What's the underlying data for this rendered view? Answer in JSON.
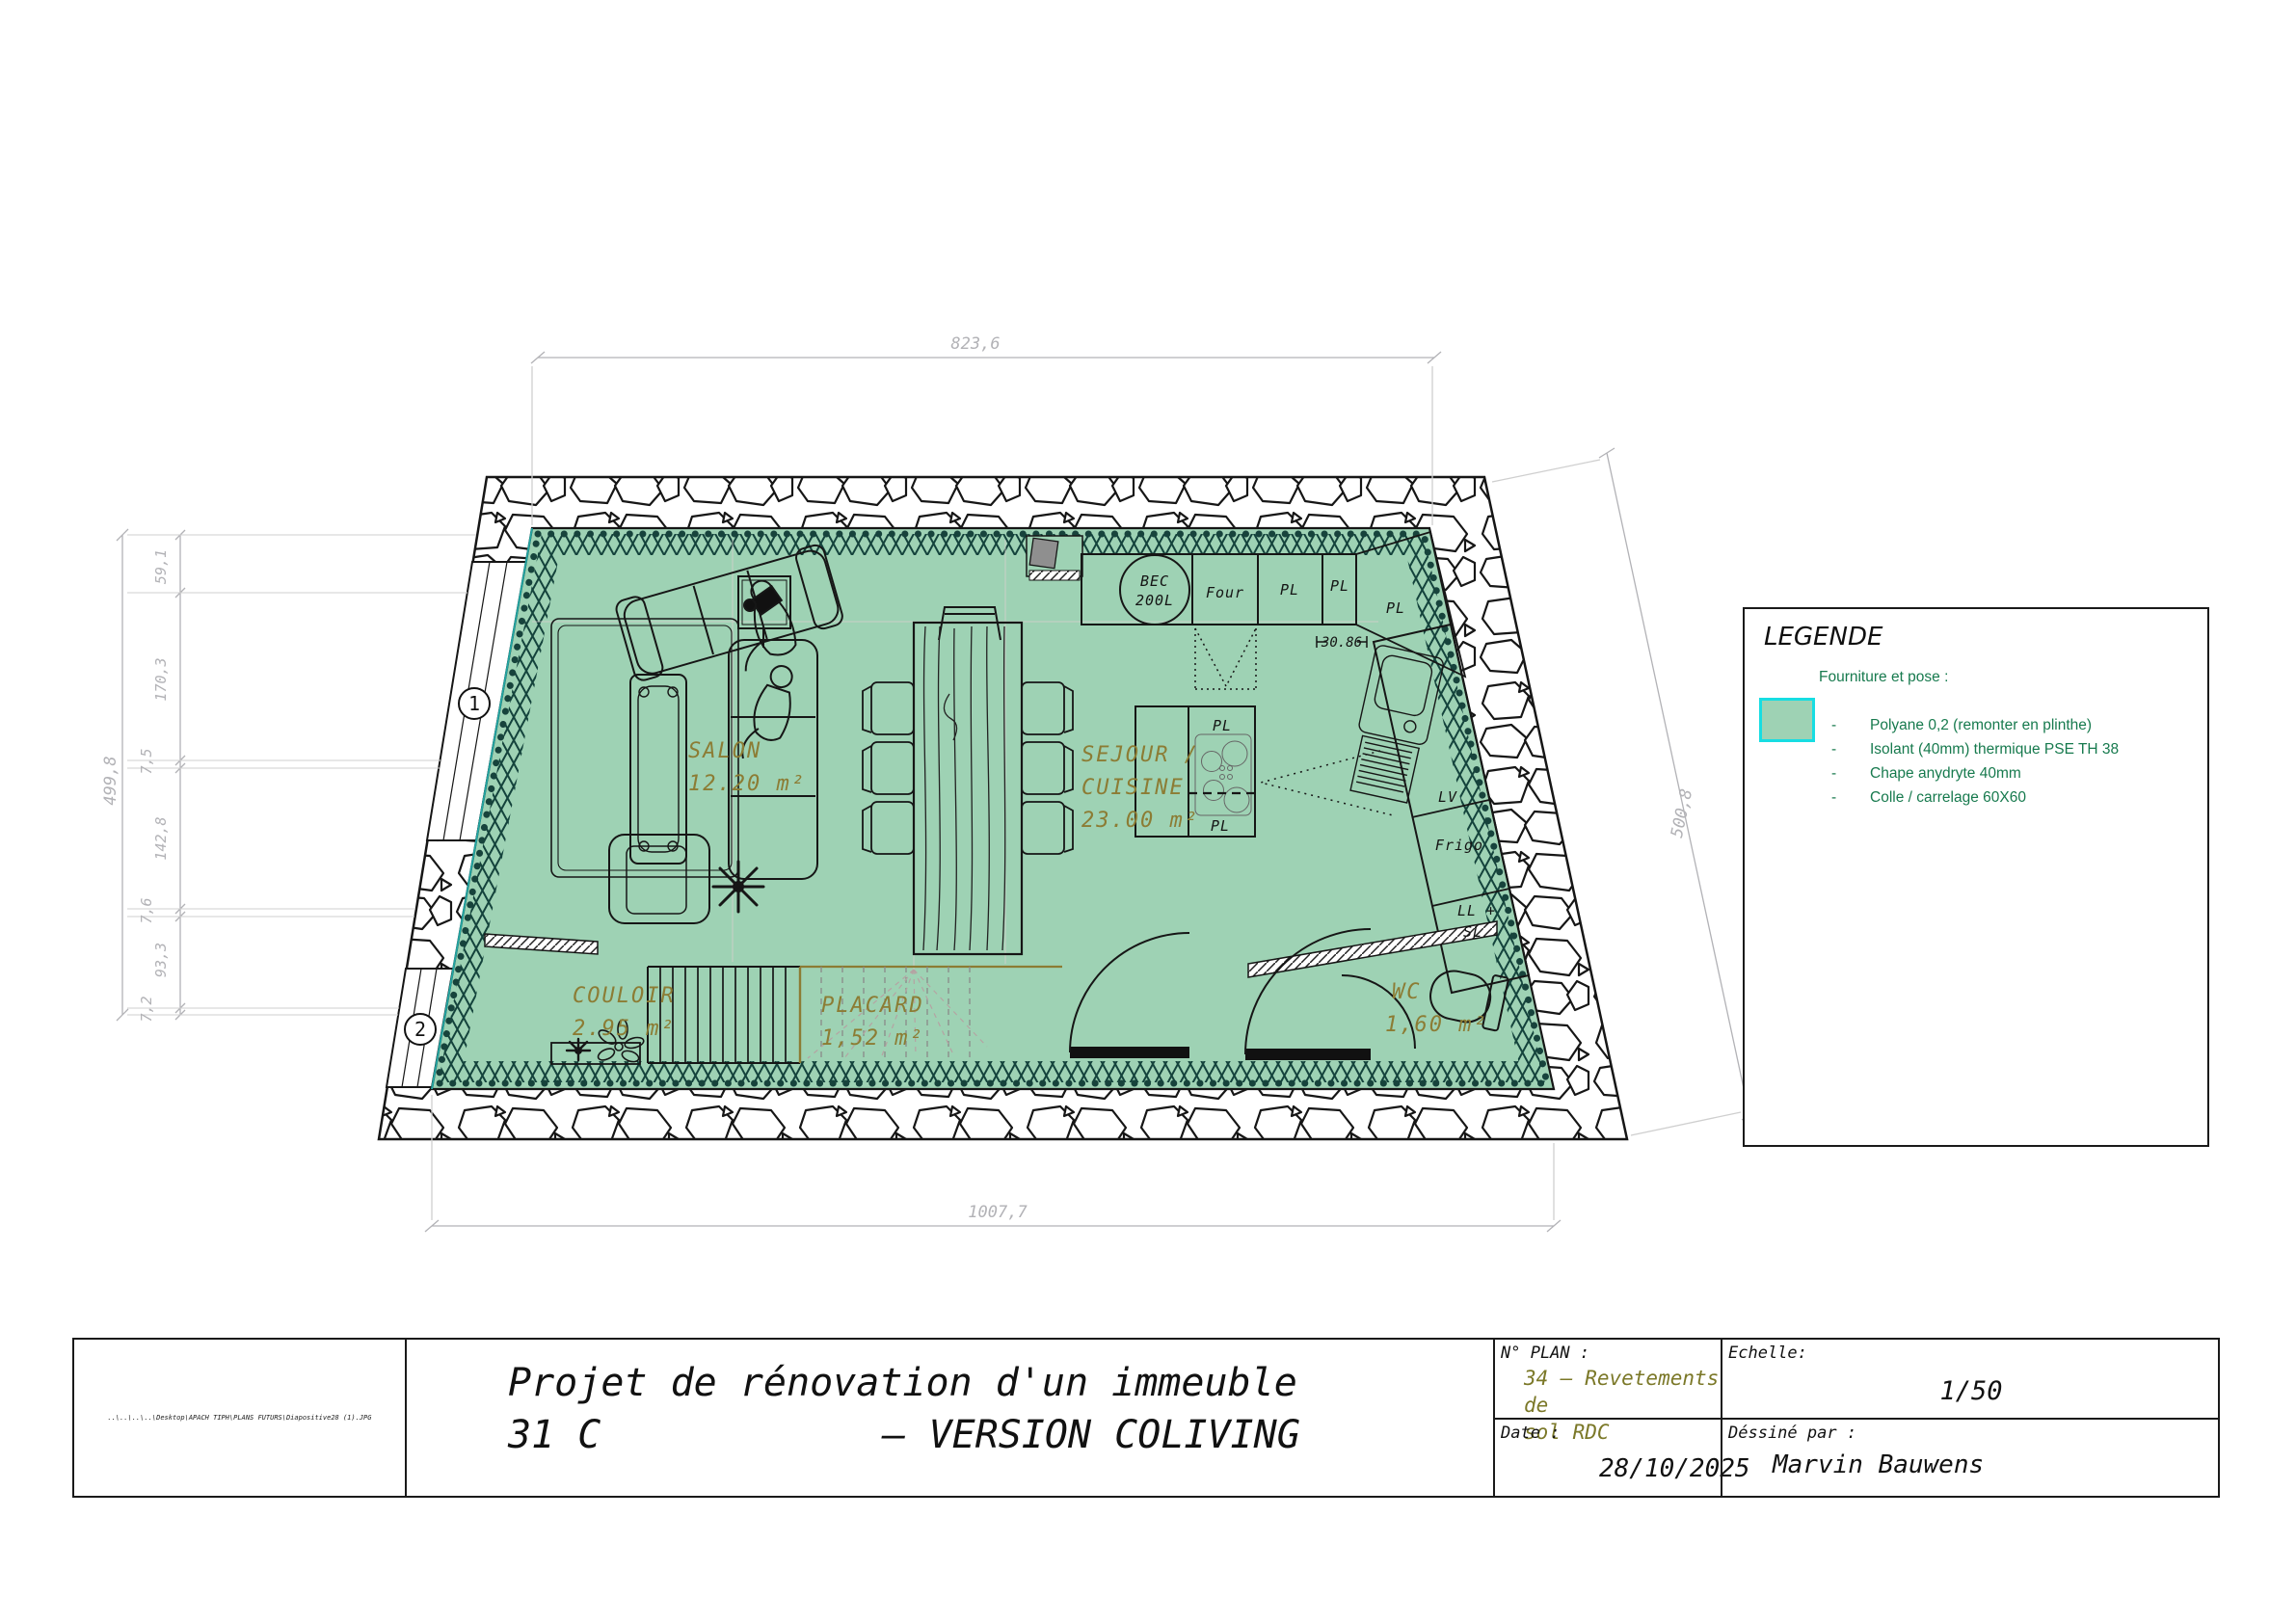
{
  "plan": {
    "dims": {
      "top": "823,6",
      "bottom": "1007,7",
      "right": "500,8",
      "left_total": "499,8",
      "left_chain": [
        "59,1",
        "170,3",
        "7,5",
        "142,8",
        "7,6",
        "93,3",
        "7,2"
      ],
      "counter": "30.86"
    },
    "markers": {
      "window1": "1",
      "window2": "2"
    },
    "rooms": {
      "salon": {
        "name": "SALON",
        "area": "12.20 m²"
      },
      "sejour": {
        "line1": "SEJOUR /",
        "line2": "CUISINE",
        "area": "23.00 m²"
      },
      "couloir": {
        "name": "COULOIR",
        "area": "2.95 m²"
      },
      "placard": {
        "name": "PLACARD",
        "area": "1,52 m²"
      },
      "wc": {
        "name": "WC",
        "area": "1,60 m²"
      }
    },
    "appliances": {
      "bec1": "BEC",
      "bec2": "200L",
      "four": "Four",
      "pl": "PL",
      "lv": "LV",
      "frigo": "Frigo",
      "ll1": "LL +",
      "ll2": "SL"
    }
  },
  "legend": {
    "title": "LEGENDE",
    "subtitle": "Fourniture et pose :",
    "bullet": "-",
    "swatch_color": "#9ed2b4",
    "swatch_border": "#17dde2",
    "items": [
      "Polyane 0,2 (remonter en plinthe)",
      "Isolant  (40mm) thermique PSE TH 38",
      "Chape anydryte 40mm",
      "Colle / carrelage 60X60"
    ]
  },
  "titleblock": {
    "path": "..\\..\\..\\..\\Desktop\\APACH TIPH\\PLANS FUTURS\\Diapositive28 (1).JPG",
    "title_line1": "Projet de rénovation d'un immeuble",
    "title_line2a": "31 C",
    "title_line2b": "– VERSION COLIVING",
    "plan_no_label": "N° PLAN :",
    "plan_no_line1": "34 – Revetements de",
    "plan_no_line2": "sol RDC",
    "echelle_label": "Echelle:",
    "echelle_value": "1/50",
    "date_label": "Date :",
    "date_value": "28/10/2025",
    "author_label": "Déssiné par :",
    "author_value": "Marvin Bauwens"
  }
}
